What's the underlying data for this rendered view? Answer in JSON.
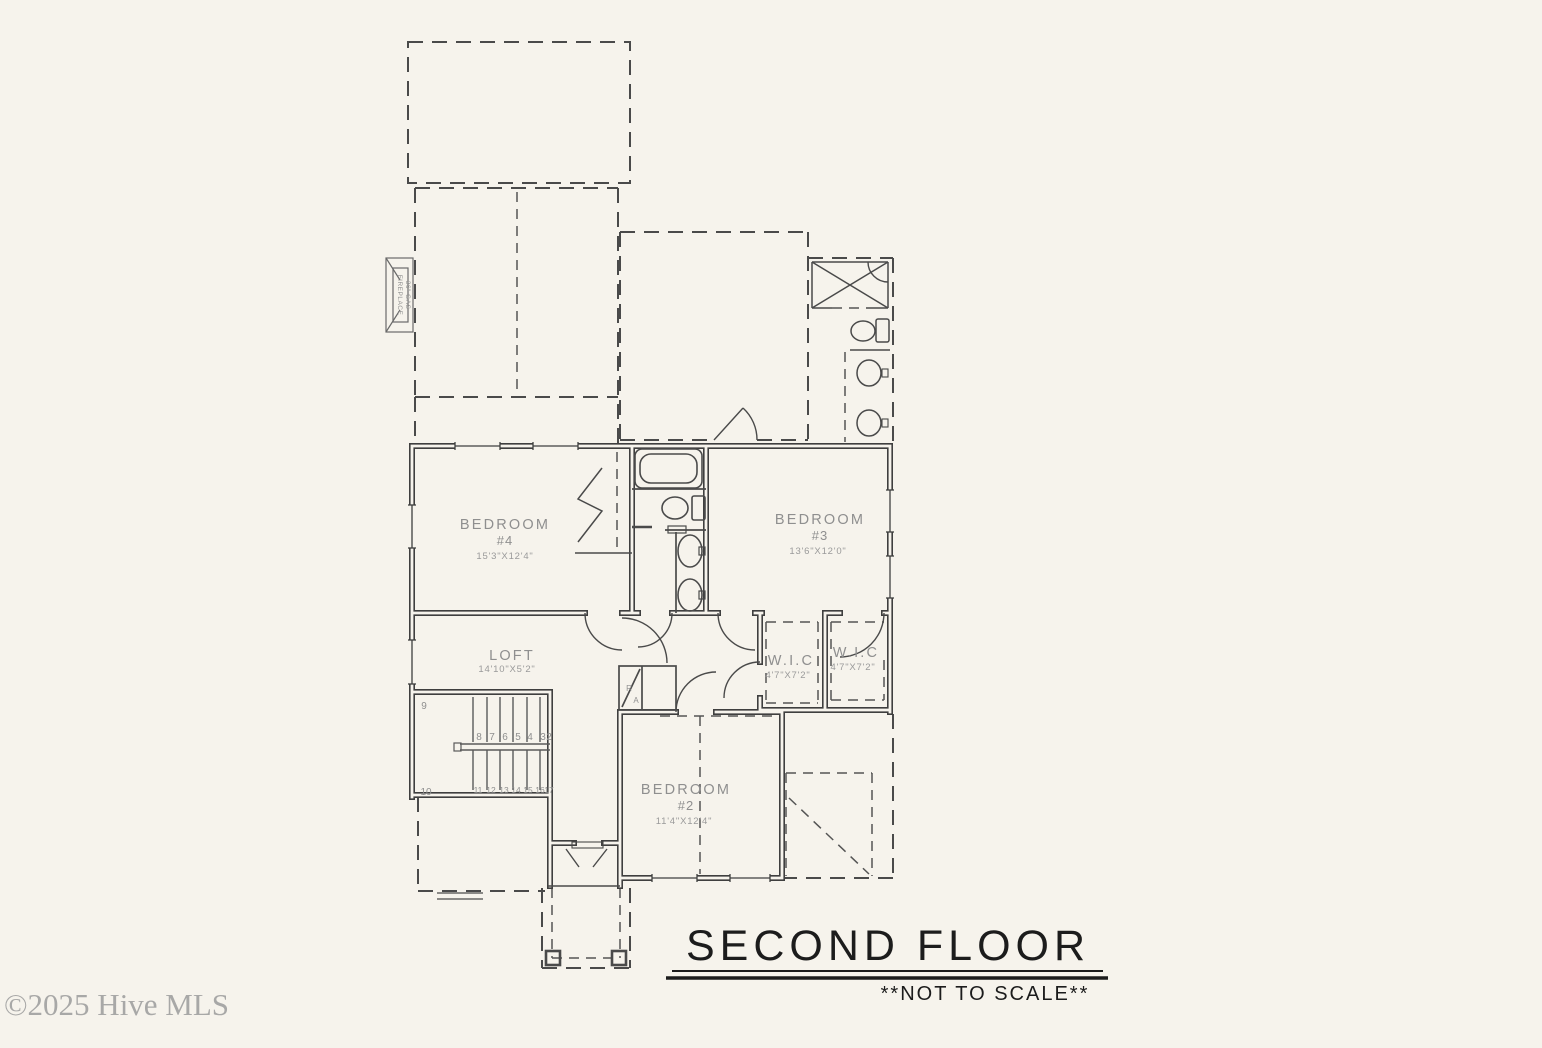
{
  "meta": {
    "floor_title": "SECOND FLOOR",
    "scale_note": "**NOT TO SCALE**",
    "watermark": "©2025 Hive MLS"
  },
  "colors": {
    "background": "#f6f3ec",
    "wall_line": "#3f3f3f",
    "label_gray": "#8f8f8f",
    "title_black": "#1c1c1c",
    "watermark_gray": "#9b9b9b"
  },
  "rooms": {
    "bedroom4": {
      "name": "BEDROOM",
      "number": "#4",
      "dims": "15'3\"X12'4\""
    },
    "bedroom3": {
      "name": "BEDROOM",
      "number": "#3",
      "dims": "13'6\"X12'0\""
    },
    "bedroom2": {
      "name": "BEDROOM",
      "number": "#2",
      "dims": "11'4\"X12'4\""
    },
    "loft": {
      "name": "LOFT",
      "dims": "14'10\"X5'2\""
    },
    "wic_left": {
      "name": "W.I.C",
      "dims": "4'7\"X7'2\""
    },
    "wic_right": {
      "name": "W.I.C",
      "dims": "4'7\"X7'2\""
    }
  },
  "stairs": {
    "upper": [
      "9",
      "8",
      "7",
      "6",
      "5",
      "4",
      "3",
      "2"
    ],
    "lower": [
      "10",
      "11",
      "12",
      "13",
      "14",
      "15",
      "16",
      "17"
    ]
  },
  "labels": {
    "return_air_r": "R",
    "return_air_a": "A",
    "fireplace_line1": "FIREPLACE",
    "fireplace_line2": "36\" GAS"
  }
}
